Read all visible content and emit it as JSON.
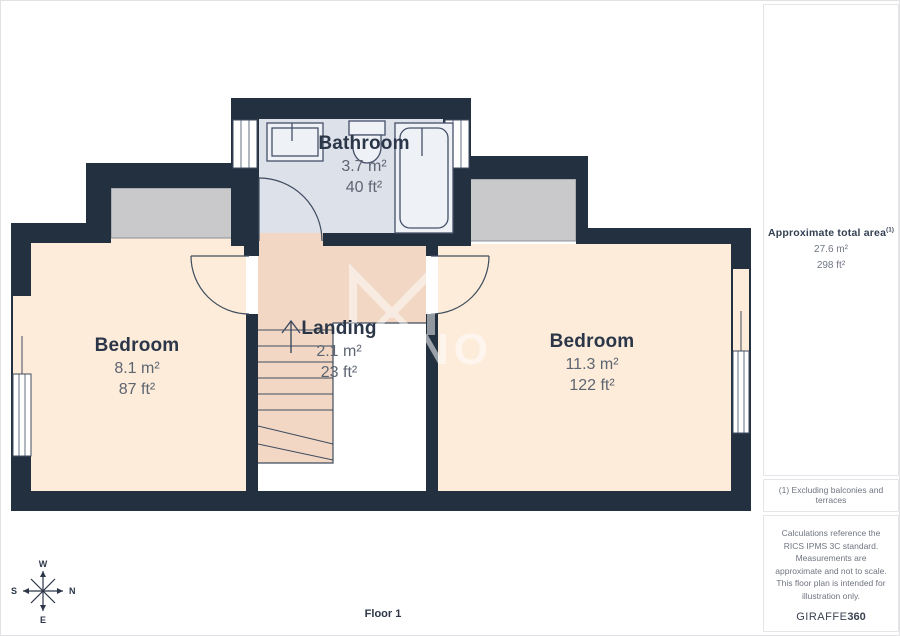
{
  "plan": {
    "floor_label": "Floor 1",
    "rooms": {
      "bathroom": {
        "name": "Bathroom",
        "area_m": "3.7 m²",
        "area_ft": "40 ft²"
      },
      "bedroom_left": {
        "name": "Bedroom",
        "area_m": "8.1 m²",
        "area_ft": "87 ft²"
      },
      "landing": {
        "name": "Landing",
        "area_m": "2.1 m²",
        "area_ft": "23 ft²"
      },
      "bedroom_right": {
        "name": "Bedroom",
        "area_m": "11.3 m²",
        "area_ft": "122 ft²"
      }
    },
    "compass": {
      "n": "N",
      "s": "S",
      "e": "E",
      "w": "W"
    },
    "watermark_letters": "NO"
  },
  "sidebar": {
    "total_area": {
      "title": "Approximate total area",
      "superscript": "(1)",
      "value_m": "27.6 m²",
      "value_ft": "298 ft²"
    },
    "footnote": "(1) Excluding balconies and terraces",
    "disclaimer": "Calculations reference the RICS IPMS 3C standard. Measurements are approximate and not to scale. This floor plan is intended for illustration only.",
    "brand": {
      "name": "GIRAFFE",
      "suffix": "360"
    }
  },
  "colors": {
    "wall": "#22303f",
    "bedroom_floor": "#fcecd9",
    "landing_floor": "#f2d8c4",
    "bathroom_floor": "#dce1ea",
    "closet_fill": "#c9c9cb",
    "line": "#3f4c5f",
    "room_text": "#2b3648",
    "area_text": "#5d6572"
  }
}
